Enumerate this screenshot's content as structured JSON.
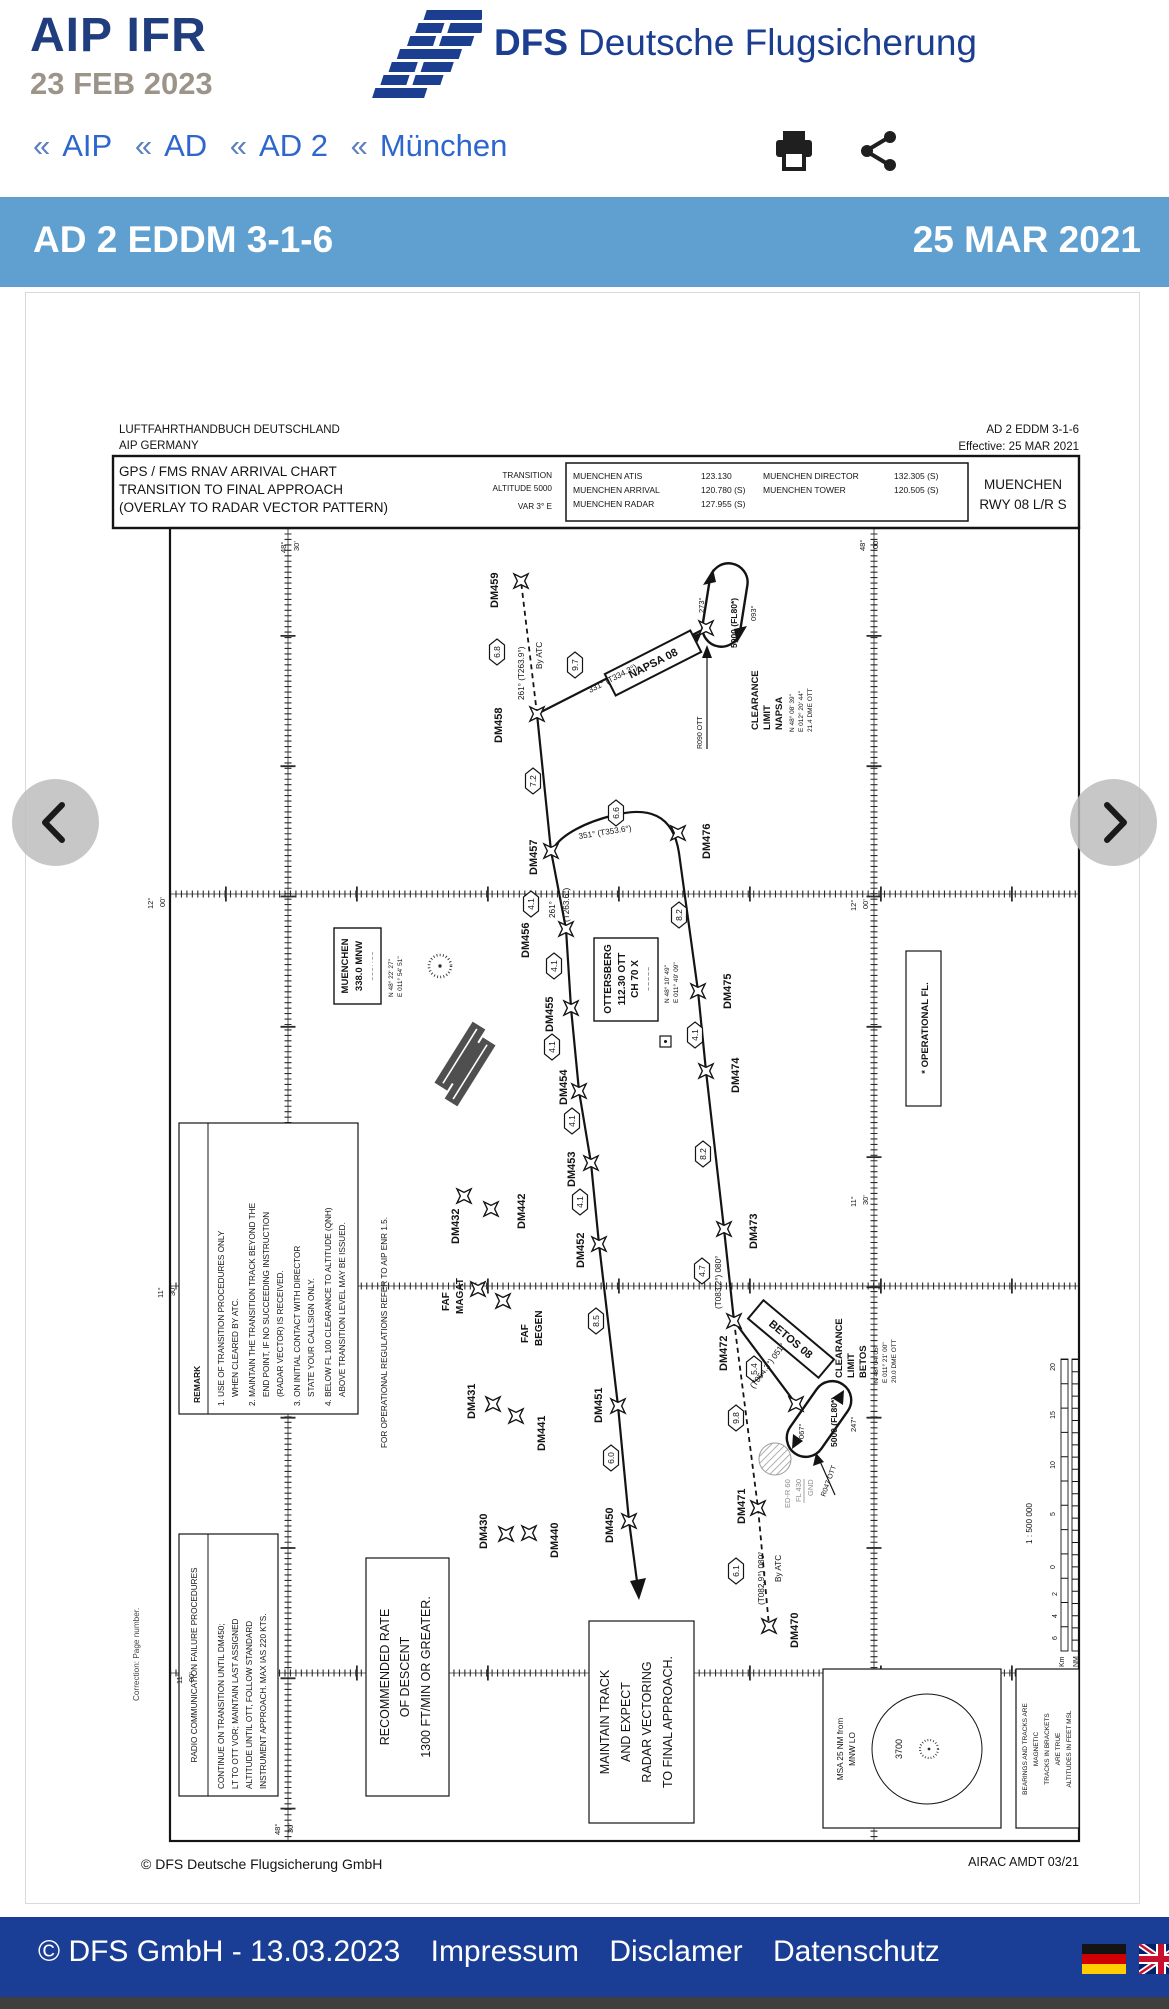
{
  "masthead": {
    "title": "AIP IFR",
    "date": "23 FEB 2023",
    "brand_bold": "DFS",
    "brand_rest": "Deutsche Flugsicherung"
  },
  "breadcrumb": {
    "sep": "«",
    "items": [
      "AIP",
      "AD",
      "AD 2",
      "München"
    ]
  },
  "icons": {
    "print": "printer",
    "share": "share"
  },
  "band": {
    "code": "AD 2 EDDM 3-1-6",
    "date": "25 MAR 2021"
  },
  "chart": {
    "pub_left1": "LUFTFAHRTHANDBUCH DEUTSCHLAND",
    "pub_left2": "AIP  GERMANY",
    "pub_right1": "AD 2 EDDM 3-1-6",
    "pub_right2": "Effective: 25 MAR 2021",
    "title1": "GPS / FMS RNAV ARRIVAL CHART",
    "title2": "TRANSITION TO FINAL APPROACH",
    "title3": "(OVERLAY TO RADAR VECTOR PATTERN)",
    "trans1": "TRANSITION",
    "trans2": "ALTITUDE 5000",
    "var": "VAR 3° E",
    "freq": {
      "col1": [
        {
          "n": "MUENCHEN ATIS",
          "f": "123.130"
        },
        {
          "n": "MUENCHEN ARRIVAL",
          "f": "120.780 (S)"
        },
        {
          "n": "MUENCHEN RADAR",
          "f": "127.955 (S)"
        }
      ],
      "col2": [
        {
          "n": "MUENCHEN DIRECTOR",
          "f": "132.305 (S)"
        },
        {
          "n": "MUENCHEN TOWER",
          "f": "120.505 (S)"
        }
      ]
    },
    "apt1": "MUENCHEN",
    "apt2": "RWY 08 L/R S",
    "wp": [
      "DM459",
      "DM458",
      "DM457",
      "DM476",
      "DM456",
      "DM475",
      "DM455",
      "DM454",
      "DM474",
      "DM453",
      "DM432",
      "DM442",
      "DM452",
      "DM473",
      "DM431",
      "DM441",
      "DM451",
      "DM472",
      "DM430",
      "DM440",
      "DM450",
      "DM471",
      "DM470"
    ],
    "faf1": [
      "FAF",
      "MAGAT"
    ],
    "faf2": [
      "FAF",
      "BEGEN"
    ],
    "hex": [
      "6.8",
      "9.7",
      "7.2",
      "6.6",
      "4.1",
      "8.2",
      "4.1",
      "4.1",
      "4.1",
      "4.1",
      "4.1",
      "8.2",
      "4.7",
      "8.5",
      "5.4",
      "9.8",
      "6.0",
      "6.1"
    ],
    "crs": [
      "261° (T263.9°)",
      "By ATC",
      "331° (T334.3°)",
      "351° (T353.6°)",
      "261°",
      "(T263.6°)",
      "(T083.2°) 080°",
      "(T054.3°) 051°",
      "(T082.9°) 080°",
      "By ATC"
    ],
    "holds": {
      "napsa": {
        "name": "NAPSA 08",
        "inb": "273°",
        "alt": "5000 (FL80*)",
        "outb": "093°",
        "radial": "R090 OTT"
      },
      "betos": {
        "name": "BETOS 08",
        "inb": "067°",
        "alt": "5000 (FL80*)",
        "outb": "247°",
        "radial": "R047 OTT"
      }
    },
    "clr_napsa": [
      "CLEARANCE",
      "LIMIT",
      "NAPSA",
      "N 48° 08' 39\"",
      "E 012° 20' 44\"",
      "21.4 DME OTT"
    ],
    "clr_betos": [
      "CLEARANCE",
      "LIMIT",
      "BETOS",
      "N 48° 04' 05\"",
      "E 011° 21' 00\"",
      "20.0 DME OTT"
    ],
    "ott": {
      "l1": "OTTERSBERG",
      "l2": "112.30 OTT",
      "l3": "CH 70 X",
      "morse": "– – –   –   –",
      "c1": "N 48° 10' 49\"",
      "c2": "E 011° 49' 09\""
    },
    "mnw": {
      "l1": "MUENCHEN",
      "l2": "338.0 MNW",
      "morse": "– –  – ·  · – –",
      "c1": "N 48° 22' 27\"",
      "c2": "E 011° 54' 51\""
    },
    "edr": [
      "ED-R 60",
      "FL 430",
      "GND"
    ],
    "opfl": "* OPERATIONAL FL.",
    "remark": {
      "title": "REMARK",
      "lines": [
        "1.  USE OF TRANSITION PROCEDURES ONLY",
        "WHEN CLEARED BY ATC.",
        "2.  MAINTAIN THE TRANSITION TRACK BEYOND THE",
        "END POINT, IF NO SUCCEEDING INSTRUCTION",
        "(RADAR VECTOR) IS RECEIVED.",
        "3.  ON INITIAL CONTACT WITH DIRECTOR",
        "STATE YOUR CALLSIGN ONLY.",
        "4.  BELOW FL 100 CLEARANCE TO ALTITUDE (QNH)",
        "ABOVE TRANSITION LEVEL MAY BE ISSUED."
      ],
      "footnote": "FOR OPERATIONAL REGULATIONS REFER TO AIP ENR 1.5."
    },
    "radio": {
      "title": "RADIO COMMUNICATION FAILURE PROCEDURES",
      "lines": [
        "CONTINUE ON TRANSITION UNTIL DM450;",
        "LT TO OTT VOR; MAINTAIN LAST ASSIGNED",
        "ALTITUDE UNTIL OTT, FOLLOW STANDARD",
        "INSTRUMENT APPROACH. MAX IAS 220 KTS."
      ]
    },
    "descent": [
      "RECOMMENDED RATE",
      "OF DESCENT",
      "1300 FT/MIN OR GREATER."
    ],
    "maintain": [
      "MAINTAIN TRACK",
      "AND EXPECT",
      "RADAR VECTORING",
      "TO FINAL APPROACH."
    ],
    "msa": {
      "l1": "MSA 25 NM from",
      "l2": "MNW LO",
      "value": "3700"
    },
    "bearings": [
      "BEARINGS AND TRACKS ARE",
      "MAGNETIC",
      "TRACKS IN BRACKETS",
      "ARE TRUE",
      "ALTITUDES IN FEET MSL"
    ],
    "scale": {
      "ratio": "1 : 500 000",
      "nm_ticks": [
        "20",
        "15",
        "10",
        "5",
        "0"
      ],
      "km_ticks": [
        "2",
        "4",
        "6"
      ],
      "km": "Km",
      "nm": "NM"
    },
    "grat": [
      {
        "a": "12°",
        "b": "00'"
      },
      {
        "a": "12°",
        "b": "00'"
      },
      {
        "a": "11°",
        "b": "30'"
      },
      {
        "a": "11°",
        "b": "30'"
      },
      {
        "a": "11°",
        "b": "00'"
      },
      {
        "a": "48°",
        "b": "30'"
      },
      {
        "a": "48°",
        "b": "00'"
      },
      {
        "a": "48°",
        "b": "30'"
      }
    ],
    "correction": "Correction: Page number.",
    "copyright": "© DFS Deutsche Flugsicherung GmbH",
    "airac": "AIRAC AMDT 03/21"
  },
  "footer": {
    "text": "© DFS GmbH - 13.03.2023",
    "links": [
      "Impressum",
      "Disclamer",
      "Datenschutz"
    ]
  }
}
